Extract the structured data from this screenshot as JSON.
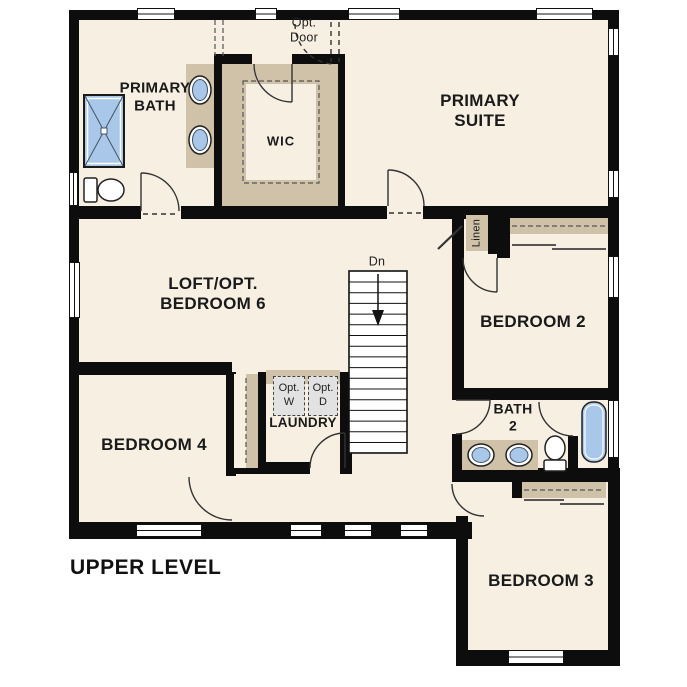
{
  "plan": {
    "title": "UPPER LEVEL",
    "rooms": {
      "primary_bath": "PRIMARY\nBATH",
      "wic": "WIC",
      "primary_suite": "PRIMARY\nSUITE",
      "loft": "LOFT/OPT.\nBEDROOM 6",
      "bedroom2": "BEDROOM 2",
      "bedroom4": "BEDROOM 4",
      "laundry": "LAUNDRY",
      "bath2": "BATH\n2",
      "bedroom3": "BEDROOM 3"
    },
    "annotations": {
      "opt_door": "Opt.\nDoor",
      "stairs_down": "Dn",
      "linen": "Linen",
      "opt_washer": "Opt.\nW",
      "opt_dryer": "Opt.\nD"
    },
    "colors": {
      "outside": "#ffffff",
      "floor": "#f6efe2",
      "wall": "#0d0d0d",
      "cabinet_tan": "#cfc2a8",
      "fixture_blue": "#a9c7e8",
      "appliance_gray": "#e2e2e2"
    }
  }
}
